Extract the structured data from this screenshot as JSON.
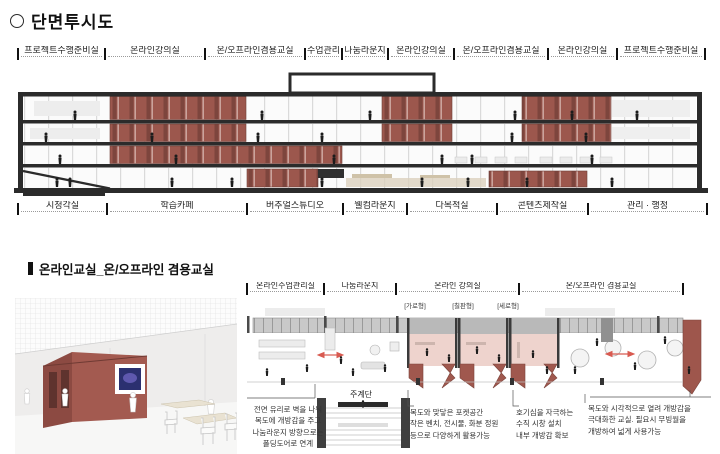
{
  "section_top": {
    "title": "단면투시도",
    "top_labels": [
      {
        "label": "프로젝트수행준비실",
        "w": 87
      },
      {
        "label": "온라인강의실",
        "w": 100
      },
      {
        "label": "온/오프라인겸용교실",
        "w": 100
      },
      {
        "label": "수업관리",
        "w": 37
      },
      {
        "label": "나눔라운지",
        "w": 46
      },
      {
        "label": "온라인강의실",
        "w": 66
      },
      {
        "label": "온/오프라인겸용교실",
        "w": 94
      },
      {
        "label": "온라인강의실",
        "w": 69
      },
      {
        "label": "프로젝트수행준비실",
        "w": 88
      }
    ],
    "bottom_labels": [
      {
        "label": "시청각실",
        "w": 89
      },
      {
        "label": "학습카페",
        "w": 140
      },
      {
        "label": "버추얼스튜디오",
        "w": 96
      },
      {
        "label": "웰컴라운지",
        "w": 64
      },
      {
        "label": "다목적실",
        "w": 90
      },
      {
        "label": "콘텐츠제작실",
        "w": 91
      },
      {
        "label": "관리 · 행정",
        "w": 119
      }
    ]
  },
  "section_bottom": {
    "title": "온라인교실_온/오프라인 겸용교실",
    "plan_labels": [
      {
        "label": "온라인수업관리실",
        "w": 77
      },
      {
        "label": "나눔라운지",
        "w": 72
      },
      {
        "label": "온라인 강의실",
        "w": 123
      },
      {
        "label": "온/오프라인 겸용교실",
        "w": 164
      }
    ],
    "type_labels": [
      {
        "label": "[가로형]",
        "x": 398
      },
      {
        "label": "[칠판형]",
        "x": 446
      },
      {
        "label": "[세로형]",
        "x": 491
      }
    ],
    "stair_label": "주계단",
    "annotations": {
      "folding_door": "전면 유리로 벽을 나눠\n복도에 개방감을 주고\n나눔라운지 방향으로는\n폴딩도어로 연계",
      "pocket_space": "복도와 맞닿은 포켓공간\n작은 벤치, 전시물, 화분 정원\n등으로 다양하게 활용가능",
      "vertical_window": "호기심을 자극하는\n수직 시창 설치\n내부 개방감 확보",
      "moving_wall": "복도와 시각적으로 열려 개방감을\n극대화한 교실. 필요시 무빙월을\n개방하여 넓게 사용가능"
    }
  },
  "colors": {
    "classroom_red": "#9c574d",
    "classroom_red_dark": "#7d453d",
    "floor_pink": "#eed3cd",
    "slab_dark": "#2b2b2b",
    "arrow_red": "#d85a50"
  }
}
